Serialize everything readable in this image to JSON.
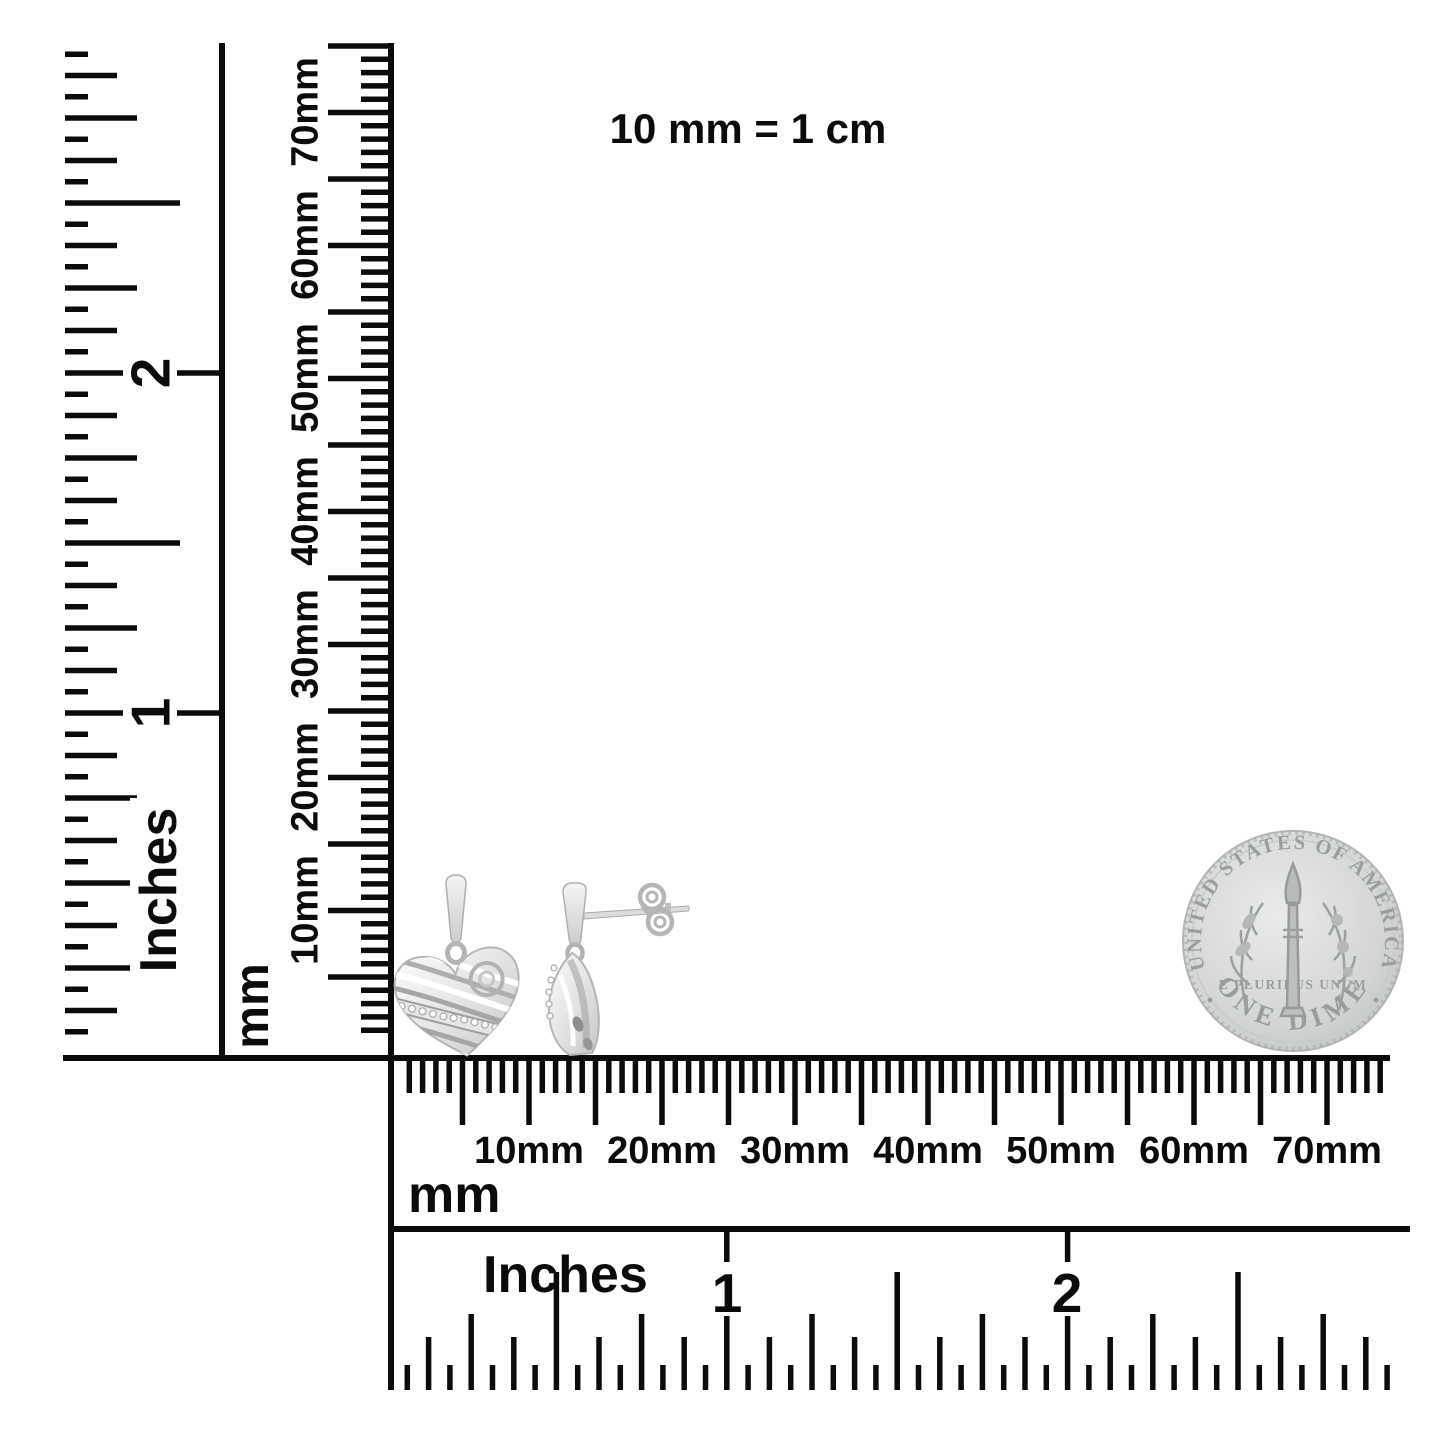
{
  "canvas": {
    "width": 1445,
    "height": 1445,
    "background": "#ffffff",
    "ink": "#0b0b0b"
  },
  "scale_note": "10 mm = 1 cm",
  "rulers": {
    "left_inches": {
      "unit": "Inches",
      "numbers": [
        "2",
        "1"
      ]
    },
    "left_mm": {
      "unit": "mm",
      "labels": [
        "70mm",
        "60mm",
        "50mm",
        "40mm",
        "30mm",
        "20mm",
        "10mm"
      ]
    },
    "bottom_mm": {
      "unit": "mm",
      "labels": [
        "10mm",
        "20mm",
        "30mm",
        "40mm",
        "50mm",
        "60mm",
        "70mm"
      ]
    },
    "bottom_inches": {
      "unit": "Inches",
      "numbers": [
        "1",
        "2"
      ]
    }
  },
  "coin": {
    "top_legend": "UNITED STATES OF AMERICA",
    "denomination": "ONE DIME",
    "motto": "E PLURIBUS UNUM",
    "body_color": "#d4d6d6",
    "relief_color": "#9a9d9d"
  },
  "product": {
    "name": "silver heart dangle earrings with diamond accents",
    "metal_color": "#ebebeb",
    "shade_color": "#a8a8a8"
  }
}
